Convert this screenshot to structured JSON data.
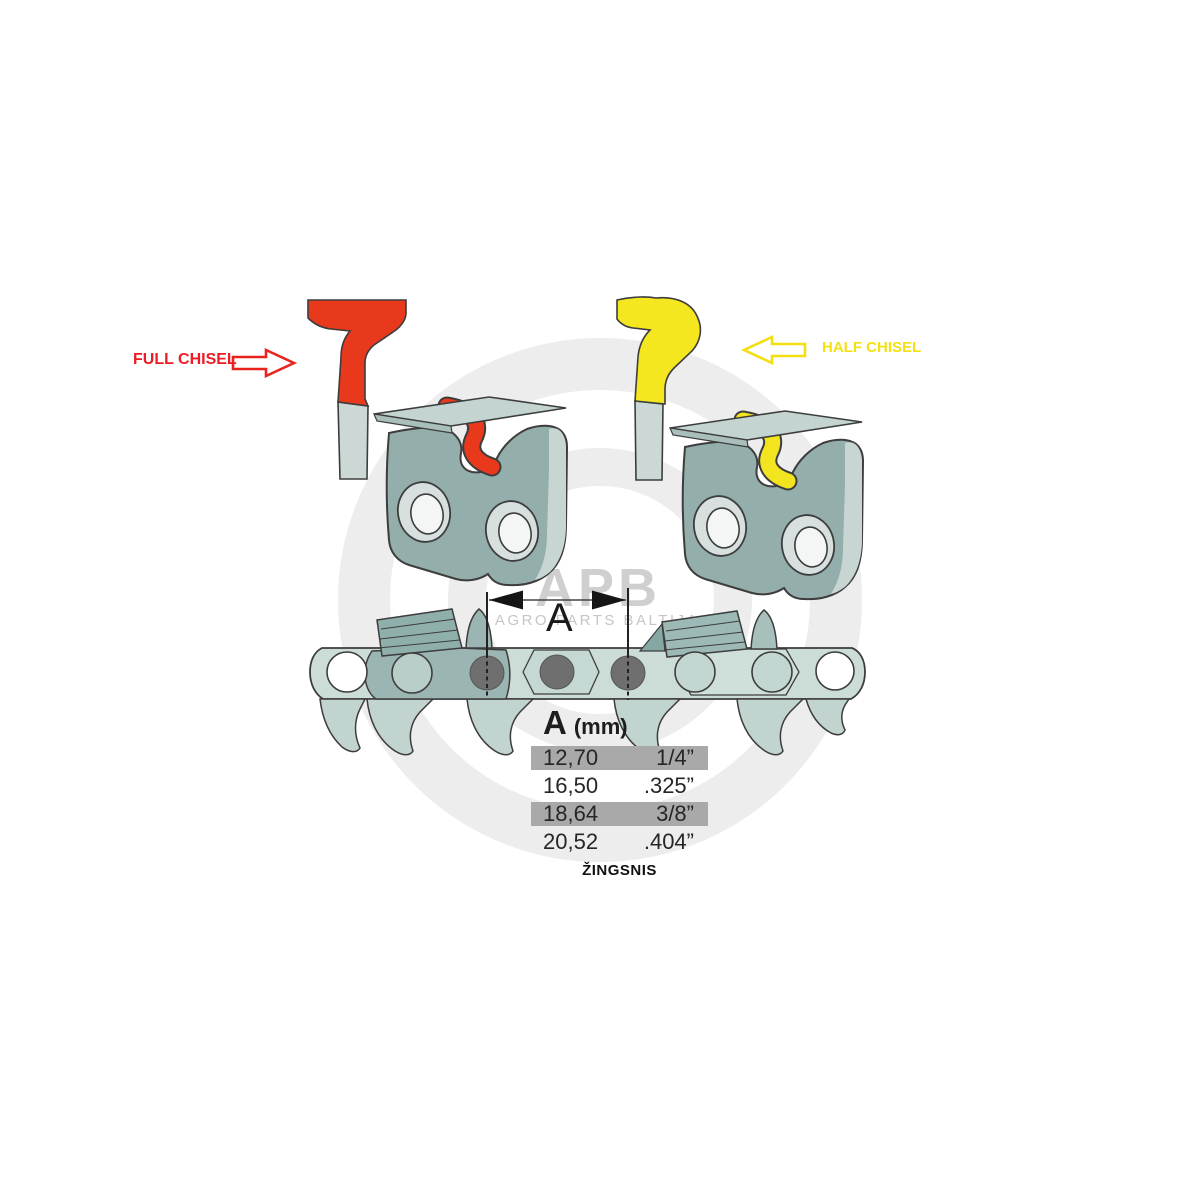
{
  "labels": {
    "full_chisel": "FULL CHISEL",
    "half_chisel": "HALF CHISEL",
    "dimension": "A",
    "pitch_caption": "ŽINGSNIS"
  },
  "table": {
    "header_letter": "A",
    "header_unit": "(mm)",
    "rows": [
      {
        "mm": "12,70",
        "inch": "1/4”",
        "highlighted": true
      },
      {
        "mm": "16,50",
        "inch": ".325”",
        "highlighted": false
      },
      {
        "mm": "18,64",
        "inch": "3/8”",
        "highlighted": true
      },
      {
        "mm": "20,52",
        "inch": ".404”",
        "highlighted": false
      }
    ]
  },
  "watermark": {
    "brand": "APB",
    "subtitle": "AGRO PARTS BALTIJA"
  },
  "colors": {
    "full_chisel_accent": "#e8391d",
    "full_chisel_text": "#ed1c24",
    "half_chisel_accent": "#f5e71f",
    "half_chisel_text": "#f3e113",
    "link_body": "#93aeab",
    "chain_band": "#ccdcd7",
    "rivet": "#6f6f6f",
    "row_highlight": "#a9a9a9"
  }
}
